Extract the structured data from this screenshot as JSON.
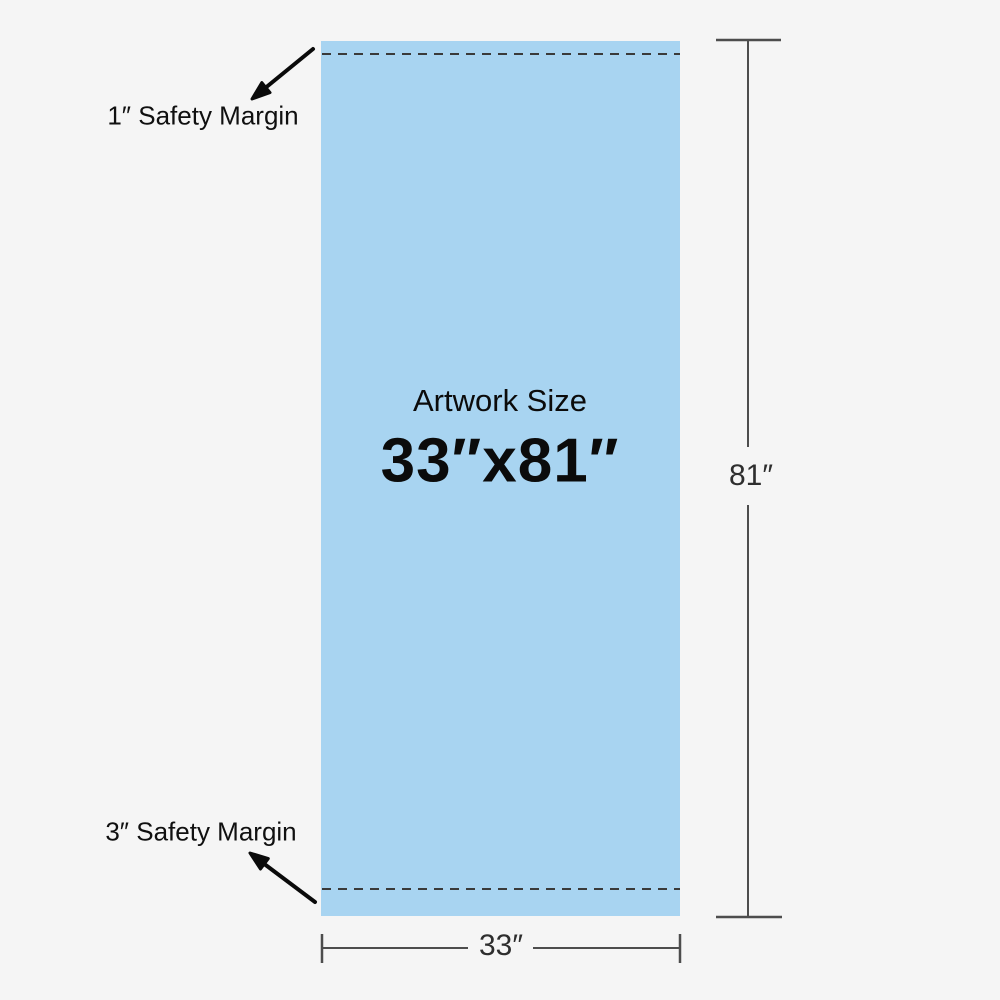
{
  "colors": {
    "background": "#F5F5F5",
    "artwork_fill": "#A8D4F1",
    "dashed_line": "#3A3A3A",
    "dimension_line": "#4D4D4D",
    "arrow": "#0A0A0A",
    "text": "#111111"
  },
  "artwork": {
    "title": "Artwork Size",
    "size": "33″x81″"
  },
  "annotations": {
    "top_safety_margin": "1″ Safety Margin",
    "bottom_safety_margin": "3″ Safety Margin"
  },
  "dimensions": {
    "height_label": "81″",
    "width_label": "33″"
  }
}
